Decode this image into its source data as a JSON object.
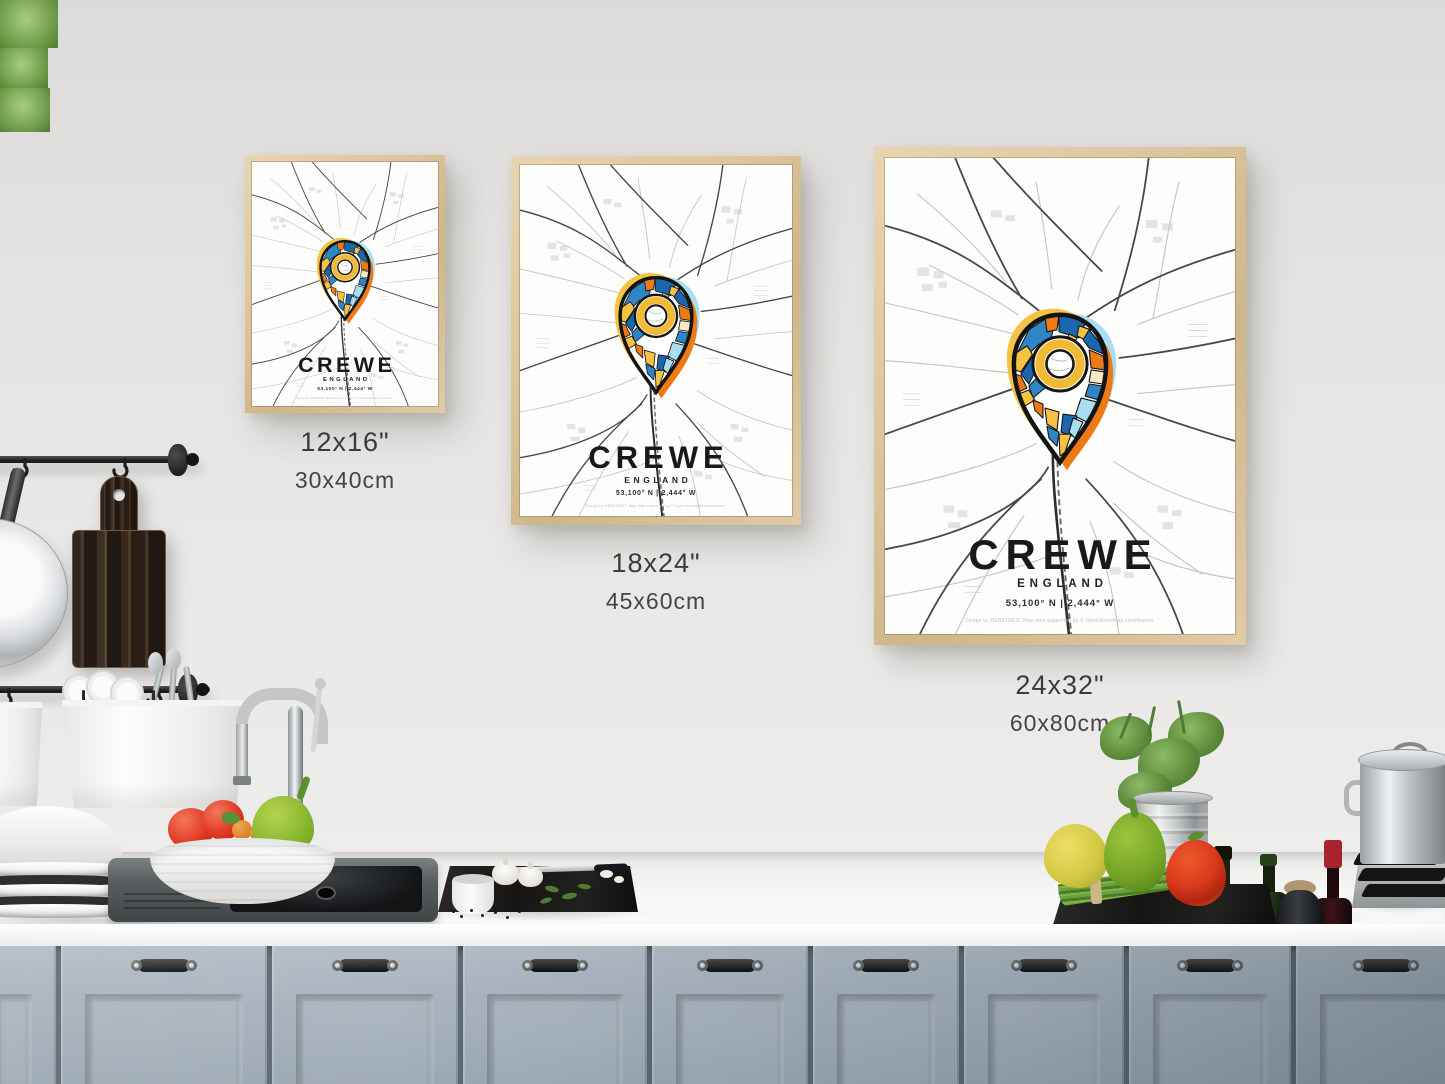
{
  "posters": {
    "small": {
      "title": "CREWE",
      "region": "ENGLAND",
      "coordinates": "53,100° N | 2,444° W",
      "credit": "Design by HEBSTREIT. Map data supported by © OpenStreetMap contributors.",
      "size_inches": "12x16\"",
      "size_cm": "30x40cm"
    },
    "medium": {
      "title": "CREWE",
      "region": "ENGLAND",
      "coordinates": "53,100° N | 2,444° W",
      "credit": "Design by HEBSTREIT. Map data supported by © OpenStreetMap contributors.",
      "size_inches": "18x24\"",
      "size_cm": "45x60cm"
    },
    "large": {
      "title": "CREWE",
      "region": "ENGLAND",
      "coordinates": "53,100° N | 2,444° W",
      "credit": "Design by HEBSTREIT. Map data supported by © OpenStreetMap contributors.",
      "size_inches": "24x32\"",
      "size_cm": "60x80cm"
    }
  },
  "icons": {
    "marker": "map-pin-icon"
  },
  "colors": {
    "pin_blue": "#1b67ad",
    "pin_mid_blue": "#2e86c7",
    "pin_light_blue": "#a9dff0",
    "pin_orange": "#ee7a16",
    "pin_yellow": "#f6c243",
    "frame_wood": "#dcc59c",
    "cabinet_blue_gray": "#a9b4be",
    "wall_gray": "#e5e4e2"
  }
}
